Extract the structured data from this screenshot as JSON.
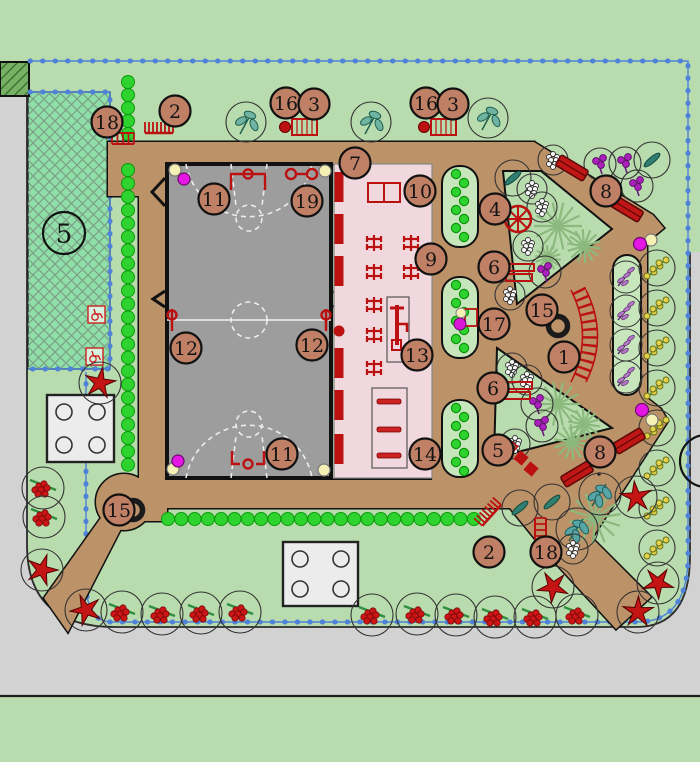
{
  "plan": {
    "colors": {
      "lawn": "#b9dcae",
      "road": "#d2d2d2",
      "path": "#bc9269",
      "court": "#9d9d9d",
      "playground": "#f0d8de",
      "parking": "#8fe0a8",
      "bed": "#c8e6bc",
      "boundary_blue": "#4f82d8",
      "accent_red": "#bb1111",
      "callout_fill": "#c08066",
      "hedge_green": "#2fd32f",
      "dark_hatch": "#79b164",
      "magenta_dot": "#e316e3",
      "yellow_dot": "#f5f1b5"
    },
    "callouts": [
      {
        "n": "18",
        "x": 107,
        "y": 122
      },
      {
        "n": "2",
        "x": 175,
        "y": 111
      },
      {
        "n": "16",
        "x": 286,
        "y": 103
      },
      {
        "n": "3",
        "x": 314,
        "y": 104
      },
      {
        "n": "16",
        "x": 426,
        "y": 103
      },
      {
        "n": "3",
        "x": 453,
        "y": 104
      },
      {
        "n": "7",
        "x": 355,
        "y": 163
      },
      {
        "n": "10",
        "x": 420,
        "y": 191
      },
      {
        "n": "4",
        "x": 495,
        "y": 209
      },
      {
        "n": "11",
        "x": 214,
        "y": 199
      },
      {
        "n": "19",
        "x": 307,
        "y": 201
      },
      {
        "n": "9",
        "x": 431,
        "y": 259
      },
      {
        "n": "6",
        "x": 494,
        "y": 267
      },
      {
        "n": "8",
        "x": 606,
        "y": 191
      },
      {
        "n": "15",
        "x": 542,
        "y": 310
      },
      {
        "n": "17",
        "x": 494,
        "y": 324
      },
      {
        "n": "12",
        "x": 186,
        "y": 348
      },
      {
        "n": "12",
        "x": 312,
        "y": 345
      },
      {
        "n": "1",
        "x": 564,
        "y": 357
      },
      {
        "n": "13",
        "x": 417,
        "y": 355
      },
      {
        "n": "6",
        "x": 493,
        "y": 388
      },
      {
        "n": "14",
        "x": 425,
        "y": 454
      },
      {
        "n": "11",
        "x": 282,
        "y": 454
      },
      {
        "n": "5",
        "x": 498,
        "y": 450
      },
      {
        "n": "8",
        "x": 600,
        "y": 452
      },
      {
        "n": "15",
        "x": 119,
        "y": 510
      },
      {
        "n": "2",
        "x": 489,
        "y": 552
      },
      {
        "n": "18",
        "x": 546,
        "y": 552
      }
    ],
    "zone_labels": [
      {
        "n": "5",
        "x": 64,
        "y": 233,
        "r": 21
      }
    ],
    "edge_circle": {
      "x": 706,
      "y": 461,
      "r": 26
    },
    "trees": {
      "leaf": [
        [
          246,
          122
        ],
        [
          371,
          122
        ],
        [
          488,
          118
        ]
      ],
      "slim": [
        [
          513,
          178
        ],
        [
          652,
          160
        ],
        [
          520,
          508
        ],
        [
          552,
          502
        ]
      ],
      "tealmulti": [
        [
          600,
          494
        ],
        [
          577,
          529
        ]
      ],
      "purple": [
        [
          545,
          272
        ],
        [
          600,
          164
        ],
        [
          625,
          163
        ],
        [
          637,
          186
        ],
        [
          537,
          404
        ],
        [
          542,
          426
        ]
      ],
      "grayberry": [
        [
          532,
          189
        ],
        [
          542,
          207
        ],
        [
          528,
          246
        ],
        [
          510,
          295
        ],
        [
          553,
          160
        ],
        [
          512,
          368
        ],
        [
          527,
          380
        ],
        [
          515,
          444
        ],
        [
          573,
          549
        ]
      ],
      "redberry": [
        [
          122,
          612
        ],
        [
          162,
          614
        ],
        [
          201,
          613
        ],
        [
          240,
          612
        ],
        [
          372,
          615
        ],
        [
          417,
          614
        ],
        [
          456,
          615
        ],
        [
          495,
          617
        ],
        [
          535,
          617
        ],
        [
          577,
          615
        ],
        [
          43,
          488
        ],
        [
          44,
          517
        ]
      ],
      "yellowberry": [
        [
          657,
          268
        ],
        [
          657,
          308
        ],
        [
          657,
          348
        ],
        [
          657,
          388
        ],
        [
          657,
          428
        ],
        [
          657,
          468
        ],
        [
          657,
          508
        ],
        [
          657,
          548
        ]
      ],
      "star": [
        [
          42,
          570
        ],
        [
          86,
          610
        ],
        [
          100,
          383
        ],
        [
          553,
          587
        ],
        [
          638,
          612
        ],
        [
          658,
          583
        ],
        [
          636,
          497
        ]
      ],
      "spiky": [
        [
          558,
          226,
          24
        ],
        [
          584,
          246,
          17
        ],
        [
          548,
          258,
          13
        ],
        [
          558,
          404,
          22
        ],
        [
          584,
          424,
          16
        ],
        [
          595,
          518,
          26
        ],
        [
          572,
          442,
          18
        ]
      ]
    },
    "hedges": {
      "left_top": {
        "x": 128,
        "y0": 82,
        "y1": 134,
        "step": 13
      },
      "left_main": {
        "x": 128,
        "y0": 170,
        "y1": 478,
        "step": 13.4
      },
      "bottom": {
        "y": 519,
        "x0": 168,
        "x1": 474,
        "step": 13.3
      }
    },
    "pavilions": [
      {
        "x": 47,
        "y": 395,
        "w": 67,
        "h": 67
      },
      {
        "x": 283,
        "y": 542,
        "w": 75,
        "h": 64
      }
    ],
    "icons": {
      "benches_hatched": [
        [
          292,
          119
        ],
        [
          431,
          119
        ]
      ],
      "urns": [
        [
          285,
          127
        ],
        [
          424,
          127
        ]
      ],
      "bike_racks": [
        {
          "x": 145,
          "y": 122,
          "rot": 0
        },
        {
          "x": 474,
          "y": 506,
          "rot": -48
        }
      ],
      "ladders": [
        {
          "x": 112,
          "y": 131,
          "dir": "h"
        },
        {
          "x": 535,
          "y": 518,
          "dir": "v"
        }
      ],
      "double_benches": [
        [
          508,
          264
        ],
        [
          506,
          382
        ]
      ],
      "walk_benches": [
        {
          "x": 572,
          "y": 168,
          "rot": 31
        },
        {
          "x": 627,
          "y": 209,
          "rot": 31
        },
        {
          "x": 577,
          "y": 474,
          "rot": -31
        },
        {
          "x": 629,
          "y": 441,
          "rot": -31
        }
      ],
      "wheel": {
        "x": 518,
        "y": 219,
        "r": 13
      },
      "rings": [
        [
          558,
          326
        ],
        [
          133,
          510
        ]
      ],
      "fountain17": {
        "yellow": [
          461,
          313
        ],
        "magenta": [
          460,
          324
        ],
        "box": [
          465,
          309,
          12,
          17
        ]
      },
      "step_squares": [
        [
          511,
          447
        ],
        [
          521,
          458
        ],
        [
          531,
          469
        ]
      ],
      "fitness_crosses": [
        [
          374,
          243
        ],
        [
          411,
          243
        ],
        [
          374,
          272
        ],
        [
          411,
          272
        ],
        [
          374,
          305
        ],
        [
          374,
          335
        ],
        [
          374,
          368
        ]
      ],
      "pink_bars_y": [
        172,
        214,
        256,
        348,
        390,
        434
      ],
      "pink_dot": [
        339,
        331
      ],
      "eq13_box": [
        387,
        297,
        22,
        65
      ],
      "eq14_box": [
        372,
        388,
        35,
        80
      ],
      "eq14_bars_y": [
        399,
        427,
        453
      ],
      "squares10": [
        368,
        183
      ],
      "posts12_x": [
        172,
        326
      ],
      "rings19": {
        "x1": 291,
        "x2": 312,
        "y": 174
      },
      "court_dots": {
        "yellow": [
          [
            175,
            170
          ],
          [
            325,
            171
          ],
          [
            173,
            469
          ],
          [
            324,
            470
          ]
        ],
        "magenta": [
          [
            184,
            179
          ],
          [
            178,
            461
          ]
        ]
      },
      "pair_dots": [
        {
          "magenta": [
            640,
            244
          ],
          "yellow": [
            651,
            240
          ]
        },
        {
          "magenta": [
            642,
            410
          ],
          "yellow": [
            652,
            420
          ]
        }
      ],
      "handicap": [
        [
          88,
          306
        ],
        [
          86,
          348
        ]
      ],
      "tip_dots": [
        [
          585,
          466
        ],
        [
          592,
          470
        ],
        [
          599,
          474
        ]
      ]
    }
  }
}
